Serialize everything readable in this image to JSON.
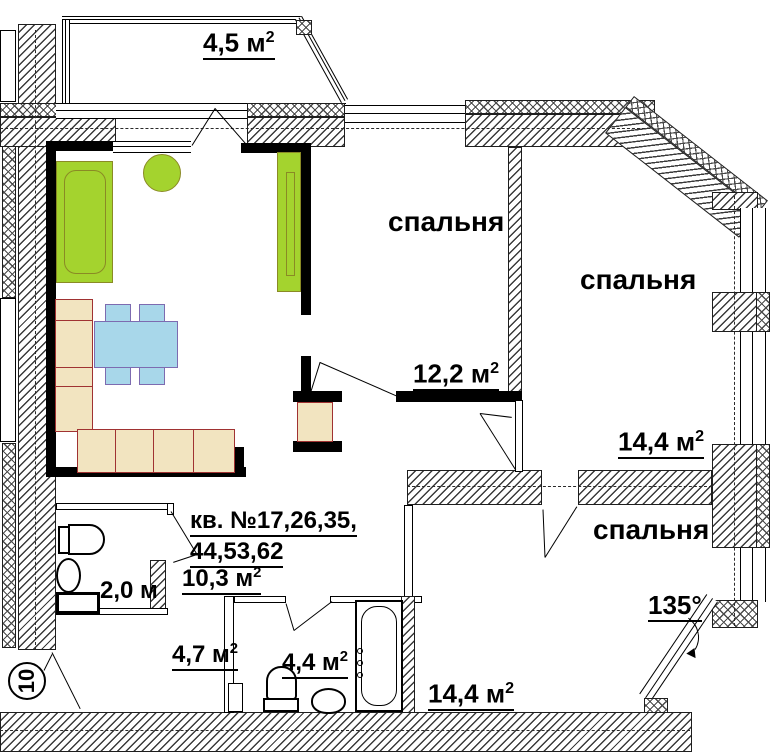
{
  "plan": {
    "balcony": {
      "area": "4,5 м",
      "area_sup": "2"
    },
    "bedroom1": {
      "label": "спальня",
      "area": "12,2 м",
      "area_sup": "2"
    },
    "bedroom2": {
      "label": "спальня",
      "area": "14,4 м",
      "area_sup": "2"
    },
    "bedroom3": {
      "label": "спальня",
      "area": "14,4 м",
      "area_sup": "2"
    },
    "corridor": {
      "apartment_line1": "кв. №17,26,35,",
      "apartment_line2": "44,53,62",
      "area": "10,3 м",
      "area_sup": "2"
    },
    "wc": {
      "width": "2,0 м"
    },
    "hall": {
      "area": "4,7 м",
      "area_sup": "2"
    },
    "bathroom": {
      "area": "4,4 м",
      "area_sup": "2"
    },
    "annotations": {
      "corner_angle": "135°",
      "axis_marker": "10"
    },
    "colors": {
      "furniture_green": "#a4d32e",
      "furniture_blue": "#a8d7ea",
      "furniture_beige": "#f2e4c0",
      "wall_black": "#000000",
      "furniture_outline_red": "#a03232"
    }
  }
}
